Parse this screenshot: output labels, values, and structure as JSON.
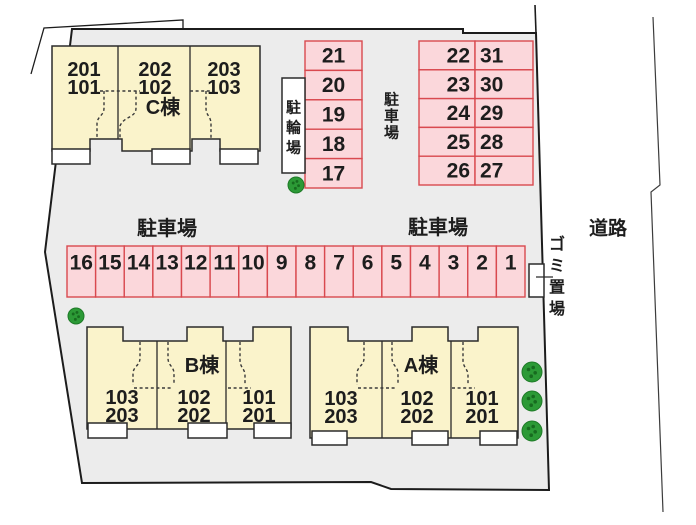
{
  "plan": {
    "road_label": "道路",
    "garbage_area_label": "ゴミ置場",
    "bicycle_area_label": "駐輪場",
    "parking_labels": {
      "upper_vertical": "駐車場",
      "middle_left": "駐車場",
      "middle_right": "駐車場"
    },
    "parking": {
      "upper_column": [
        "21",
        "20",
        "19",
        "18",
        "17"
      ],
      "upper_block": {
        "left_column": [
          "22",
          "23",
          "24",
          "25",
          "26"
        ],
        "right_column": [
          "31",
          "30",
          "29",
          "28",
          "27"
        ]
      },
      "middle_row": [
        "16",
        "15",
        "14",
        "13",
        "12",
        "11",
        "10",
        "9",
        "8",
        "7",
        "6",
        "5",
        "4",
        "3",
        "2",
        "1"
      ]
    },
    "buildings": {
      "c": {
        "name": "C棟",
        "units": [
          [
            "201",
            "101"
          ],
          [
            "202",
            "102"
          ],
          [
            "203",
            "103"
          ]
        ]
      },
      "b": {
        "name": "B棟",
        "units": [
          [
            "103",
            "203"
          ],
          [
            "102",
            "202"
          ],
          [
            "101",
            "201"
          ]
        ]
      },
      "a": {
        "name": "A棟",
        "units": [
          [
            "103",
            "203"
          ],
          [
            "102",
            "202"
          ],
          [
            "101",
            "201"
          ]
        ]
      }
    },
    "colors": {
      "site_fill": "#ececec",
      "parking_fill": "#fbd7db",
      "parking_border": "#d9494f",
      "building_fill": "#faf3cb",
      "outline": "#1c1c1c",
      "tree_green": "#2c9a36"
    }
  }
}
